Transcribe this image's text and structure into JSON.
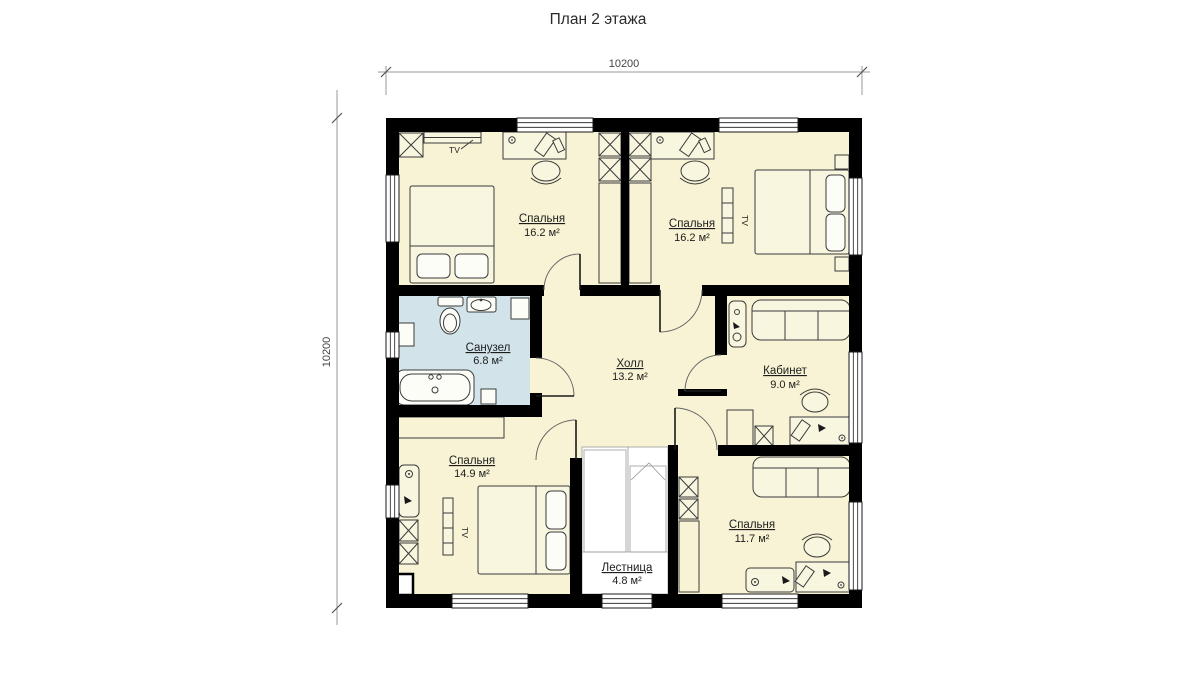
{
  "title": "План 2 этажа",
  "dimensions": {
    "width": "10200",
    "height": "10200"
  },
  "rooms": [
    {
      "id": "bedroom-top-left",
      "name": "Спальня",
      "area": "16.2 м²"
    },
    {
      "id": "bedroom-top-right",
      "name": "Спальня",
      "area": "16.2 м²"
    },
    {
      "id": "bathroom",
      "name": "Санузел",
      "area": "6.8 м²"
    },
    {
      "id": "hall",
      "name": "Холл",
      "area": "13.2 м²"
    },
    {
      "id": "office",
      "name": "Кабинет",
      "area": "9.0 м²"
    },
    {
      "id": "bedroom-bottom-left",
      "name": "Спальня",
      "area": "14.9 м²"
    },
    {
      "id": "stairs",
      "name": "Лестница",
      "area": "4.8 м²"
    },
    {
      "id": "bedroom-bottom-right",
      "name": "Спальня",
      "area": "11.7 м²"
    }
  ],
  "labels": {
    "tv": "TV"
  },
  "colors": {
    "wall": "#000000",
    "room_fill": "#f7f3d4",
    "bathroom_fill": "#d2e4e9",
    "stairs_fill": "#ffffff",
    "furniture_fill": "#f9f6e0",
    "dimension_text": "#444444"
  }
}
